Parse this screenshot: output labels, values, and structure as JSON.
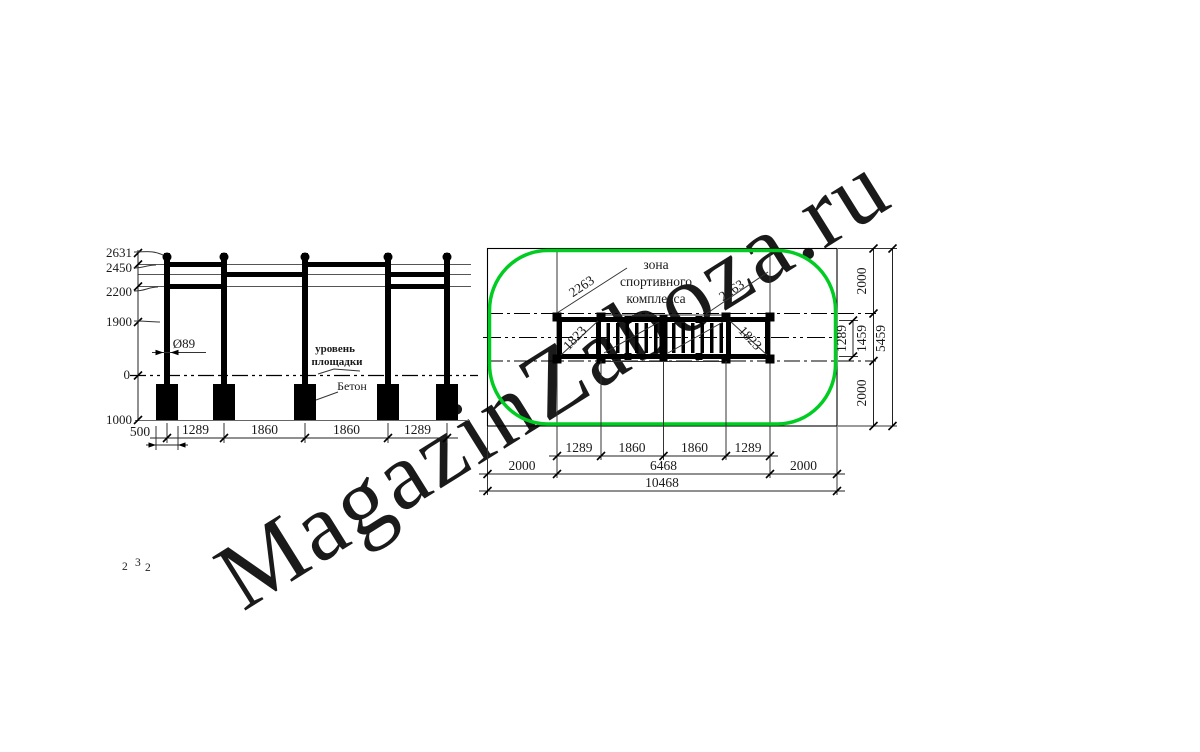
{
  "watermark": {
    "text": "MagazinZaboza.ru"
  },
  "corner_note": {
    "d1": "2",
    "d2": "3",
    "d3": "2"
  },
  "colors": {
    "zone_green": "#00cc22",
    "accent_red": "#ff0000",
    "watermark_gray": "#d9d9d9"
  },
  "elevation": {
    "height_labels": [
      "2631",
      "2450",
      "2200",
      "1900",
      "0",
      "1000"
    ],
    "diameter_label": "Ø89",
    "level_label_line1": "уровень",
    "level_label_line2": "площадки",
    "concrete_label": "Бетон",
    "span_labels": [
      "1289",
      "1860",
      "1860",
      "1289"
    ],
    "foundation_width_label": "500"
  },
  "plan": {
    "zone_label": [
      "зона",
      "спортивного",
      "комплекса"
    ],
    "diagonal_dims": {
      "left_2263": "2263",
      "right_2263": "2263",
      "left_1823": "1823",
      "right_1823": "1823"
    },
    "right_dims": {
      "top_2000": "2000",
      "inner_1289": "1289",
      "middle_1459": "1459",
      "bottom_2000": "2000",
      "overall_5459": "5459"
    },
    "bottom_row1": [
      "1289",
      "1860",
      "1860",
      "1289"
    ],
    "bottom_row2": [
      "2000",
      "6468",
      "2000"
    ],
    "bottom_row3": "10468"
  }
}
